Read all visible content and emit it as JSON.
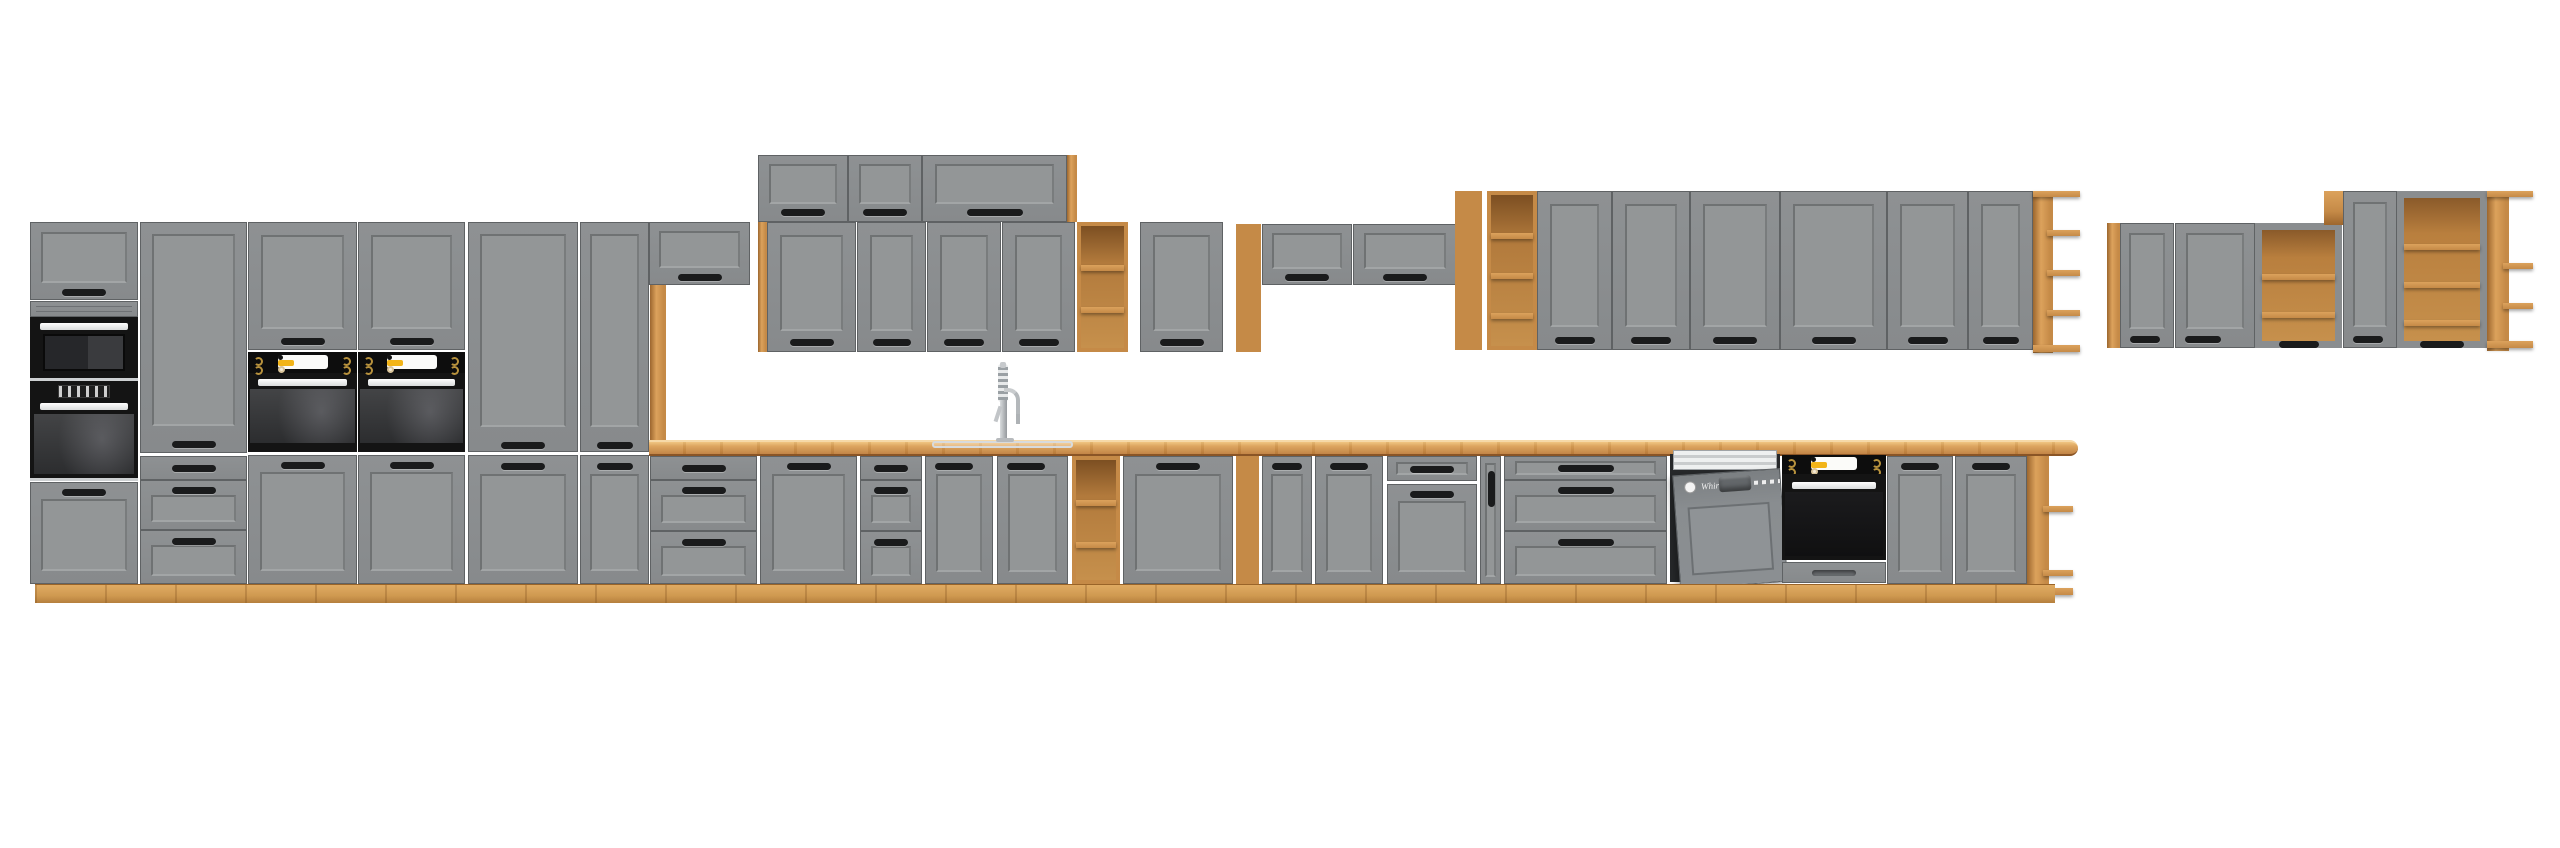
{
  "scene": {
    "type": "product-photo",
    "subject": "Long modular kitchen cabinet set with grey shaker fronts, artisan oak carcass/worktop and black built-in appliances on a white background",
    "background": "#ffffff"
  },
  "colors": {
    "bg": "#ffffff",
    "front": "#8a8d8f",
    "front-light": "#939697",
    "front-dark": "#6e7174",
    "seam": "#5f6264",
    "wood": "#c58a47",
    "wood-light": "#dca25c",
    "wood-dark": "#9c662e",
    "wood-deep": "#6f4619",
    "black": "#151515",
    "glass": "#3a3b3d",
    "steel": "#c3c7ca",
    "yellow": "#f2b418",
    "gold": "#b8923d",
    "handle": "#1a1b1c",
    "plinth": "#d6a057"
  },
  "appliances": {
    "dishwasher_brand": "Whirlpool",
    "items": [
      "built-in microwave",
      "built-in oven with display (tall column)",
      "two built-in ovens with yellow-display control panels (tall towers)",
      "semi-integrated dishwasher with door ajar",
      "under-counter built-in oven",
      "chrome spring-neck sink tap",
      "inset sink"
    ]
  },
  "inventory": {
    "tall_left_block": [
      "oven & microwave tower with top and bottom doors",
      "pantry column with tall door and 3 drawers",
      "oven tower 1 (wall door / oven / base door)",
      "oven tower 2 (wall door / oven / base door)",
      "double-door tall pantry 60",
      "double-door tall pantry 40"
    ],
    "wall_middle": [
      "flip-up wall cabinet over peninsula with oak support post",
      "stacked top row of 3 flip-up cabinets with oak end panel",
      "row of 4 shaker wall doors with oak end strip",
      "open oak shelf unit (3 compartments)",
      "shaker wall cabinet 80",
      "oak wine-rack column (5 cubbies)",
      "flip-up wall cabinet 80",
      "flip-up wall cabinet 100"
    ],
    "wall_right_group": [
      "oak cubby column (6 cells)",
      "open oak shelf unit (4 compartments)",
      "6 shaker wall doors",
      "oak open end shelves"
    ],
    "wall_far_right_group": [
      "oak end panel",
      "wall door 40",
      "wall door 60",
      "open display cabinet with oak shelves",
      "tall wall door 40",
      "tall open display cabinet with oak shelves",
      "oak open end shelves"
    ],
    "base_run": [
      "3-drawer base 80",
      "door base 80",
      "3-drawer base 40",
      "sink base door x2",
      "open oak base shelf",
      "door base 80",
      "oak base wine rack",
      "door base 40",
      "door base 50",
      "drawer-over-door base",
      "cargo pull-out 15 with vertical handle",
      "3-drawer base 80 wide",
      "dishwasher 60 (door ajar)",
      "built-in oven base 60",
      "door base 40 x2",
      "oak open end shelf"
    ],
    "worktop": "artisan oak worktop with inset sink and tall spring tap, rounded right end",
    "plinth": "continuous oak plinth"
  }
}
